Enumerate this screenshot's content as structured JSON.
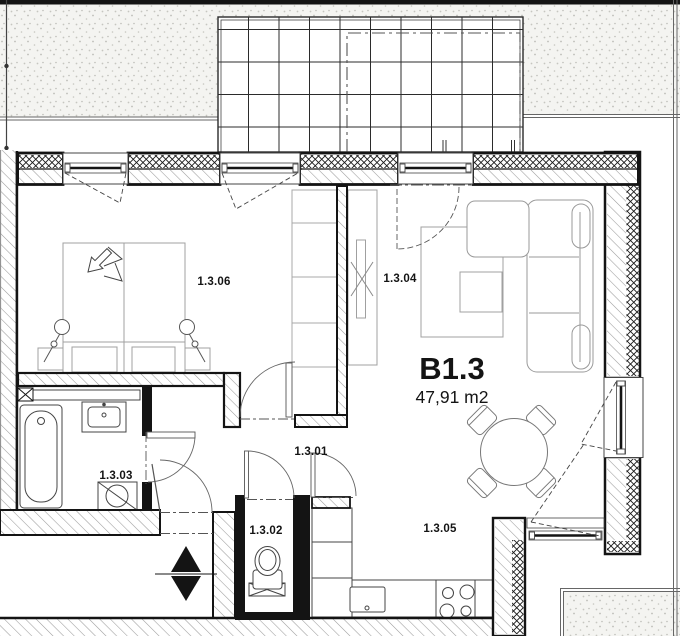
{
  "plan": {
    "unit": {
      "label": "B1.3",
      "area": "47,91 m2"
    },
    "rooms": [
      {
        "label": "1.3.01"
      },
      {
        "label": "1.3.02"
      },
      {
        "label": "1.3.03"
      },
      {
        "label": "1.3.04"
      },
      {
        "label": "1.3.05"
      },
      {
        "label": "1.3.06"
      }
    ],
    "icons": {
      "stairs_up": "up-triangle",
      "stairs_down": "down-triangle"
    },
    "colors": {
      "line": "#141414",
      "wall_hatch": "#9c9c9c",
      "insulation": "#1a1a1a",
      "stipple_bg": "#f4f4f1",
      "stipple_dot": "#bdbdb8",
      "paper": "#ffffff"
    }
  }
}
